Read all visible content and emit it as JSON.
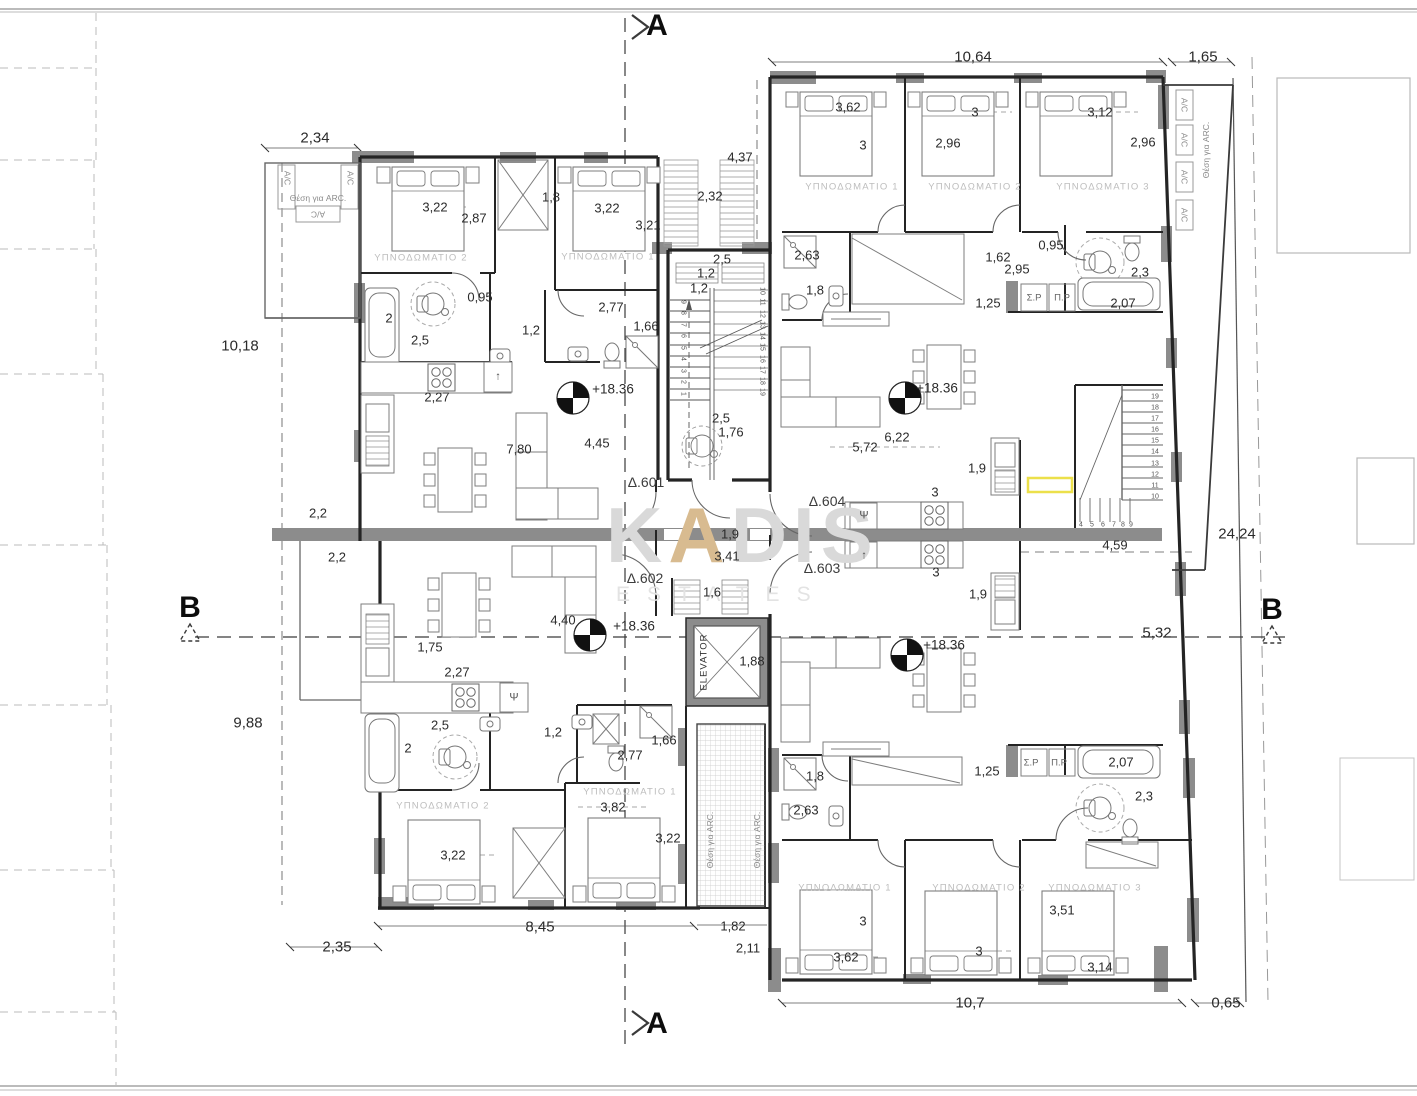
{
  "page": {
    "width": 1417,
    "height": 1096,
    "background": "#ffffff"
  },
  "watermark": {
    "prefix": "K",
    "accent": "A",
    "rest": "DIS",
    "sub": "ESTATES",
    "color": "#d9d9d9",
    "accent_color": "#d8bb90"
  },
  "drawing": {
    "type": "architectural-floor-plan",
    "level_value": "+18.36",
    "apartments": [
      "Δ.601",
      "Δ.602",
      "Δ.603",
      "Δ.604"
    ],
    "section_markers": [
      "A",
      "B"
    ],
    "elevator_label": "ELEVATOR",
    "bedroom_word": "ΥΠΝΟΔΩΜΑΤΙΟ",
    "arc_note": "Θέση για ARC.",
    "ac_label": "A/C",
    "wall_color": "#2a2a2a",
    "poche_color": "#8c8c8c",
    "highlight_color": "#ece04a"
  },
  "labels": [
    [
      "10,64",
      973,
      57,
      "big"
    ],
    [
      "1,65",
      1203,
      57,
      "big"
    ],
    [
      "2,34",
      315,
      138,
      "big"
    ],
    [
      "10,18",
      240,
      346,
      "big"
    ],
    [
      "9,88",
      248,
      723,
      "big"
    ],
    [
      "24,24",
      1237,
      534,
      "big"
    ],
    [
      "8,45",
      540,
      927,
      "big"
    ],
    [
      "2,35",
      337,
      947,
      "big"
    ],
    [
      "10,7",
      970,
      1003,
      "big"
    ],
    [
      "0,65",
      1226,
      1003,
      "big"
    ],
    [
      "5,32",
      1157,
      633,
      "big"
    ],
    [
      "4,59",
      1115,
      545,
      "dim"
    ],
    [
      "3,62",
      848,
      107
    ],
    [
      "3",
      863,
      145
    ],
    [
      "3",
      975,
      112
    ],
    [
      "2,96",
      948,
      143
    ],
    [
      "3,12",
      1100,
      112
    ],
    [
      "2,96",
      1143,
      142
    ],
    [
      "4,37",
      740,
      157
    ],
    [
      "2,32",
      710,
      196
    ],
    [
      "3,22",
      435,
      207
    ],
    [
      "2,87",
      474,
      218
    ],
    [
      "1,8",
      551,
      197
    ],
    [
      "3,22",
      607,
      208
    ],
    [
      "3,21",
      648,
      225
    ],
    [
      "0,95",
      480,
      297
    ],
    [
      "2",
      389,
      318
    ],
    [
      "2,5",
      420,
      340
    ],
    [
      "1,2",
      531,
      330
    ],
    [
      "2,77",
      611,
      307
    ],
    [
      "1,66",
      646,
      326
    ],
    [
      "2,5",
      722,
      259
    ],
    [
      "1,2",
      706,
      273
    ],
    [
      "1,2",
      699,
      288
    ],
    [
      "2,63",
      807,
      255
    ],
    [
      "1,8",
      815,
      290
    ],
    [
      "1,62",
      998,
      257
    ],
    [
      "2,95",
      1017,
      269
    ],
    [
      "0,95",
      1051,
      245
    ],
    [
      "2,3",
      1140,
      272
    ],
    [
      "1,25",
      988,
      303
    ],
    [
      "2,07",
      1123,
      303
    ],
    [
      "Σ.Ρ",
      1034,
      298,
      "sp"
    ],
    [
      "Π.Ρ",
      1062,
      298,
      "sp"
    ],
    [
      "2,27",
      437,
      397
    ],
    [
      "+18.36",
      613,
      389,
      "lvl"
    ],
    [
      "+18.36",
      937,
      388,
      "lvl"
    ],
    [
      "7,80",
      519,
      449
    ],
    [
      "4,45",
      597,
      443
    ],
    [
      "2,5",
      721,
      418
    ],
    [
      "1,76",
      731,
      432
    ],
    [
      "5,72",
      865,
      447
    ],
    [
      "6,22",
      897,
      437
    ],
    [
      "1,9",
      977,
      468
    ],
    [
      "3",
      935,
      492
    ],
    [
      "2,2",
      318,
      513
    ],
    [
      "1,9",
      730,
      534
    ],
    [
      "3,41",
      727,
      556
    ],
    [
      "2,2",
      337,
      557
    ],
    [
      "3",
      936,
      572
    ],
    [
      "1,9",
      978,
      594
    ],
    [
      "1,6",
      712,
      592
    ],
    [
      "4,40",
      563,
      620
    ],
    [
      "+18.36",
      634,
      626,
      "lvl"
    ],
    [
      "1,75",
      430,
      647
    ],
    [
      "+18.36",
      944,
      645,
      "lvl"
    ],
    [
      "2,27",
      457,
      672
    ],
    [
      "2,5",
      440,
      725
    ],
    [
      "2",
      408,
      748
    ],
    [
      "1,2",
      553,
      732
    ],
    [
      "2,77",
      630,
      755
    ],
    [
      "1,66",
      664,
      740
    ],
    [
      "1,8",
      815,
      776
    ],
    [
      "2,63",
      806,
      810
    ],
    [
      "1,25",
      987,
      771
    ],
    [
      "2,07",
      1121,
      762
    ],
    [
      "2,3",
      1144,
      796
    ],
    [
      "Σ.Ρ",
      1031,
      763,
      "sp"
    ],
    [
      "Π.Ρ",
      1059,
      763,
      "sp"
    ],
    [
      "3,82",
      613,
      807
    ],
    [
      "3,22",
      453,
      855
    ],
    [
      "3,22",
      668,
      838
    ],
    [
      "3,51",
      1062,
      910
    ],
    [
      "3",
      863,
      921
    ],
    [
      "3",
      979,
      951
    ],
    [
      "3,62",
      846,
      957
    ],
    [
      "3,14",
      1100,
      967
    ],
    [
      "1,82",
      733,
      926
    ],
    [
      "2,11",
      748,
      948
    ],
    [
      "1,88",
      752,
      661
    ],
    [
      "ΥΠΝΟΔΩΜΑΤΙΟ 2",
      421,
      258,
      "room"
    ],
    [
      "ΥΠΝΟΔΩΜΑΤΙΟ 1",
      608,
      257,
      "room"
    ],
    [
      "ΥΠΝΟΔΩΜΑΤΙΟ 1",
      852,
      187,
      "room"
    ],
    [
      "ΥΠΝΟΔΩΜΑΤΙΟ 2",
      975,
      187,
      "room"
    ],
    [
      "ΥΠΝΟΔΩΜΑΤΙΟ 3",
      1103,
      187,
      "room"
    ],
    [
      "ΥΠΝΟΔΩΜΑΤΙΟ 2",
      443,
      806,
      "room"
    ],
    [
      "ΥΠΝΟΔΩΜΑΤΙΟ 1",
      630,
      792,
      "room"
    ],
    [
      "ΥΠΝΟΔΩΜΑΤΙΟ 1",
      845,
      888,
      "room"
    ],
    [
      "ΥΠΝΟΔΩΜΑΤΙΟ 2",
      979,
      888,
      "room"
    ],
    [
      "ΥΠΝΟΔΩΜΑΤΙΟ 3",
      1095,
      888,
      "room"
    ],
    [
      "Δ.601",
      646,
      482,
      "apt"
    ],
    [
      "Δ.602",
      645,
      578,
      "apt"
    ],
    [
      "Δ.604",
      827,
      501,
      "apt"
    ],
    [
      "Δ.603",
      822,
      568,
      "apt"
    ],
    [
      "Θέση για ARC.",
      318,
      198,
      "tiny"
    ],
    [
      "A/C",
      287,
      178,
      "tiny",
      90
    ],
    [
      "A/C",
      350,
      178,
      "tiny",
      90
    ],
    [
      "A/C",
      318,
      214,
      "tiny",
      180
    ],
    [
      "A/C",
      1184,
      105,
      "tiny",
      90
    ],
    [
      "A/C",
      1184,
      140,
      "tiny",
      90
    ],
    [
      "A/C",
      1184,
      177,
      "tiny",
      90
    ],
    [
      "A/C",
      1184,
      215,
      "tiny",
      90
    ],
    [
      "Θέση για ARC.",
      1206,
      150,
      "tiny",
      -90
    ],
    [
      "Θέση για ARC.",
      710,
      840,
      "tiny",
      -90
    ],
    [
      "Θέση για ARC.",
      757,
      840,
      "tiny",
      -90
    ],
    [
      "ELEVATOR",
      704,
      662,
      "elev",
      -90
    ],
    [
      "Ψ",
      864,
      516,
      "sym"
    ],
    [
      "↑",
      864,
      556,
      "sym"
    ],
    [
      "↑",
      498,
      377,
      "sym"
    ],
    [
      "Ψ",
      514,
      698,
      "sym"
    ],
    [
      "A",
      657,
      26,
      "sec"
    ],
    [
      "A",
      657,
      1024,
      "sec"
    ],
    [
      "B",
      190,
      608,
      "sec"
    ],
    [
      "B",
      1272,
      610,
      "sec"
    ],
    [
      "1",
      683,
      394,
      "snum",
      90
    ],
    [
      "2",
      683,
      382,
      "snum",
      90
    ],
    [
      "3",
      683,
      371,
      "snum",
      90
    ],
    [
      "4",
      683,
      359,
      "snum",
      90
    ],
    [
      "5",
      683,
      348,
      "snum",
      90
    ],
    [
      "6",
      683,
      336,
      "snum",
      90
    ],
    [
      "7",
      683,
      325,
      "snum",
      90
    ],
    [
      "8",
      683,
      313,
      "snum",
      90
    ],
    [
      "9",
      683,
      302,
      "snum",
      90
    ],
    [
      "10",
      762,
      291,
      "snum",
      90
    ],
    [
      "11",
      762,
      302,
      "snum",
      90
    ],
    [
      "12",
      762,
      314,
      "snum",
      90
    ],
    [
      "13",
      762,
      325,
      "snum",
      90
    ],
    [
      "14",
      762,
      336,
      "snum",
      90
    ],
    [
      "15",
      762,
      347,
      "snum",
      90
    ],
    [
      "16",
      762,
      359,
      "snum",
      90
    ],
    [
      "17",
      762,
      370,
      "snum",
      90
    ],
    [
      "18",
      762,
      381,
      "snum",
      90
    ],
    [
      "19",
      762,
      392,
      "snum",
      90
    ],
    [
      "4",
      1081,
      525,
      "snum"
    ],
    [
      "5",
      1092,
      525,
      "snum"
    ],
    [
      "6",
      1103,
      525,
      "snum"
    ],
    [
      "7",
      1114,
      525,
      "snum"
    ],
    [
      "8",
      1123,
      525,
      "snum"
    ],
    [
      "9",
      1131,
      525,
      "snum"
    ],
    [
      "10",
      1155,
      497,
      "snum"
    ],
    [
      "11",
      1155,
      486,
      "snum"
    ],
    [
      "12",
      1155,
      475,
      "snum"
    ],
    [
      "13",
      1155,
      464,
      "snum"
    ],
    [
      "14",
      1155,
      452,
      "snum"
    ],
    [
      "15",
      1155,
      441,
      "snum"
    ],
    [
      "16",
      1155,
      430,
      "snum"
    ],
    [
      "17",
      1155,
      419,
      "snum"
    ],
    [
      "18",
      1155,
      408,
      "snum"
    ],
    [
      "19",
      1155,
      397,
      "snum"
    ]
  ]
}
